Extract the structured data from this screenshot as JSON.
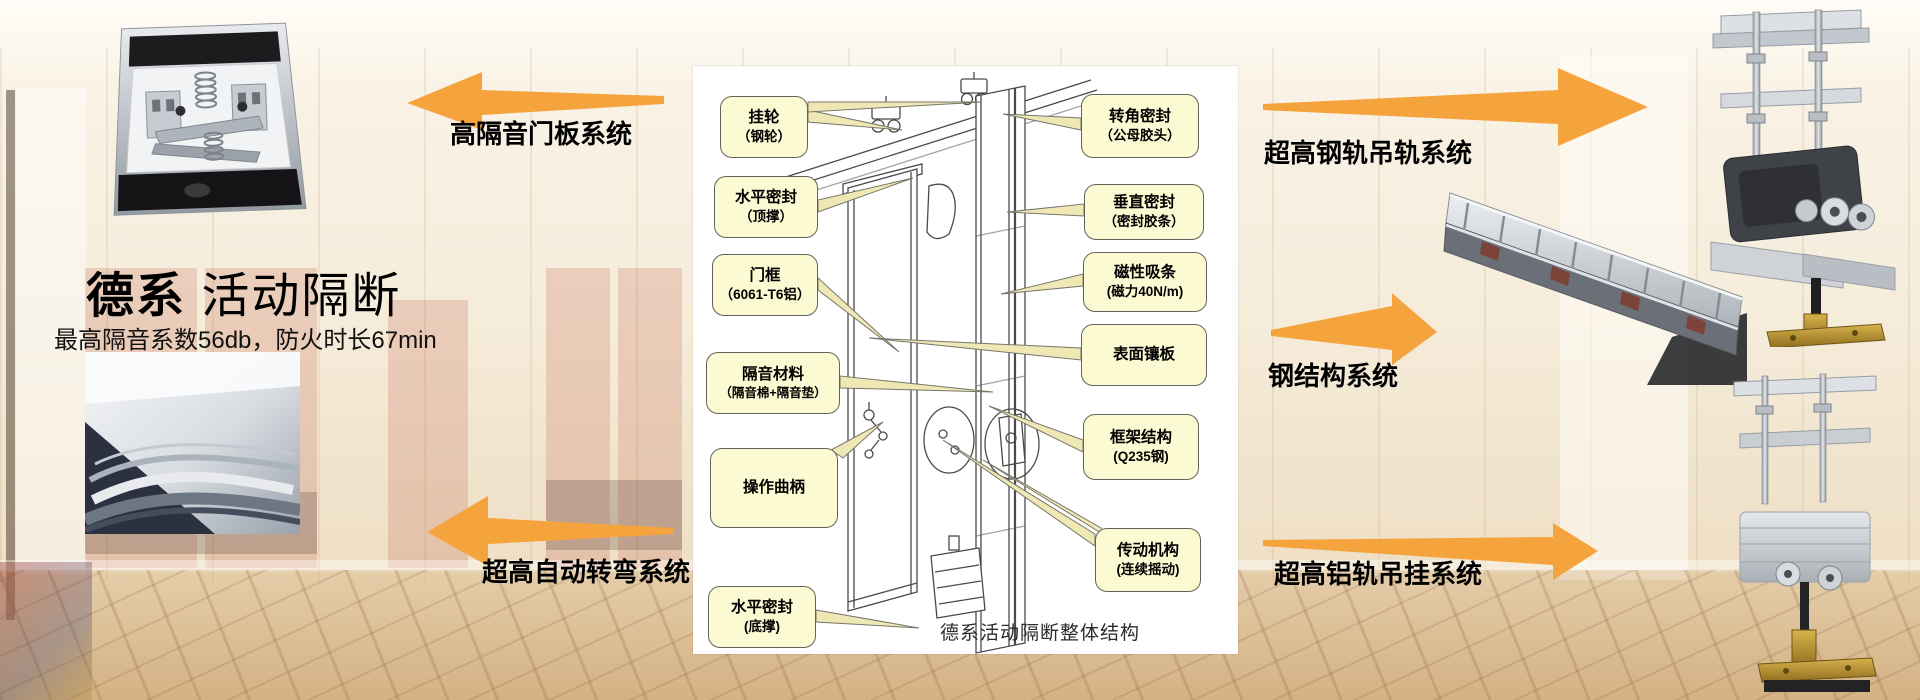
{
  "brand": {
    "title_bold": "德系",
    "title_light": "活动隔断",
    "subtitle": "最高隔音系数56db，防火时长67min"
  },
  "features": {
    "door_panel": "高隔音门板系统",
    "auto_turning": "超高自动转弯系统",
    "steel_rail": "超高钢轨吊轨系统",
    "steel_structure": "钢结构系统",
    "aluminum_rail": "超高铝轨吊挂系统"
  },
  "diagram": {
    "caption": "德系活动隔断整体结构",
    "left_callouts": [
      {
        "line1": "挂轮",
        "line2": "（钢轮）"
      },
      {
        "line1": "水平密封",
        "line2": "（顶撑）"
      },
      {
        "line1": "门框",
        "line2": "（6061-T6铝）"
      },
      {
        "line1": "隔音材料",
        "line2": "（隔音棉+隔音垫）"
      },
      {
        "line1": "操作曲柄",
        "line2": ""
      },
      {
        "line1": "水平密封",
        "line2": "(底撑)"
      }
    ],
    "right_callouts": [
      {
        "line1": "转角密封",
        "line2": "（公母胶头）"
      },
      {
        "line1": "垂直密封",
        "line2": "（密封胶条）"
      },
      {
        "line1": "磁性吸条",
        "line2": "(磁力40N/m)"
      },
      {
        "line1": "表面镶板",
        "line2": ""
      },
      {
        "line1": "框架结构",
        "line2": "(Q235钢)"
      },
      {
        "line1": "传动机构",
        "line2": "(连续摇动)"
      }
    ]
  },
  "photos": {
    "top_left": "door-panel-top-mechanism",
    "bottom_left": "curved-track-detail",
    "top_right": "steel-rail-trolley",
    "mid_right": "steel-structure-frame",
    "bottom_right": "aluminum-rail-trolley"
  },
  "colors": {
    "arrow": "#F5A43D",
    "callout_bg": "#FCFAD2",
    "callout_border": "#63635A",
    "panel_bg": "#FFFFFF",
    "leader_fill": "#EFE8B5",
    "leader_stroke": "#77766A"
  }
}
